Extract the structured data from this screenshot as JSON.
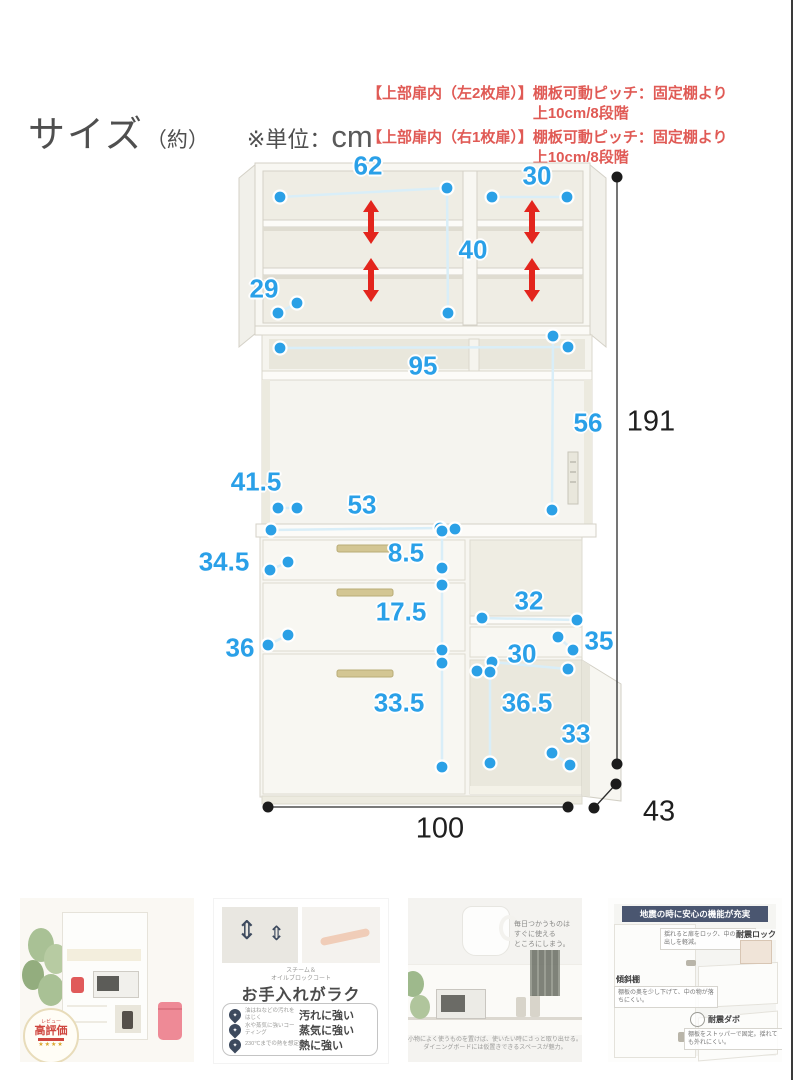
{
  "header": {
    "title_main": "サイズ",
    "title_paren": "（約）",
    "unit_prefix": "※単位：",
    "unit": "cm"
  },
  "notes": [
    {
      "bracket": "【上部扉内（左2枚扉）】",
      "text": "棚板可動ピッチ：固定棚より上10cm/8段階"
    },
    {
      "bracket": "【上部扉内（右1枚扉）】",
      "text": "棚板可動ピッチ：固定棚より上10cm/8段階"
    }
  ],
  "dims": {
    "w_top_left": "62",
    "w_top_right": "30",
    "h_top_inner": "40",
    "d_top": "29",
    "w_niche": "95",
    "h_niche": "56",
    "h_total": "191",
    "d_counter": "41.5",
    "w_counter_left": "53",
    "h_drawer1": "8.5",
    "d_drawer1": "34.5",
    "h_drawer2": "17.5",
    "d_drawer2": "36",
    "w_right_inner": "32",
    "h_right_drawer": "35",
    "w_right_lower": "30",
    "h_drawer3": "33.5",
    "h_right_lower": "36.5",
    "w_door": "33",
    "w_total": "100",
    "d_total": "43"
  },
  "colors": {
    "dim_blue": "#2AA0E8",
    "arrow_red": "#E3251D",
    "note_red": "#E05A55",
    "navy": "#4A5670",
    "black_dim": "#1F1F1F"
  },
  "thumbnails": {
    "thumb1": {
      "badge_top": "レビュー",
      "badge_main": "高評価",
      "badge_stars": "★★★★"
    },
    "thumb2": {
      "coat_line1": "スチーム＆",
      "coat_line2": "オイルブロックコート",
      "heading": "お手入れがラク",
      "rows": [
        {
          "icon": "stain-resistant-icon",
          "note": "油はねなどの汚れをはじく",
          "label": "汚れに強い"
        },
        {
          "icon": "steam-resistant-icon",
          "note": "水や蒸気に強いコーティング",
          "label": "蒸気に強い"
        },
        {
          "icon": "heat-resistant-icon",
          "note": "230℃までの熱を想定",
          "label": "熱に強い"
        }
      ]
    },
    "thumb3": {
      "note_line1": "毎日つかうものは",
      "note_line2": "すぐに使える",
      "note_line3": "ところにしまう。",
      "caption_line1": "小物によく使うものを置けば、使いたい時にさっと取り出せる。",
      "caption_line2": "ダイニングボードには仮置きできるスペースが魅力。"
    },
    "thumb4": {
      "header": "地震の時に安心の機能が充実",
      "label_lock": "耐震ロック",
      "tip_lock": "揺れると扉をロック、中の飛び出しを軽減。",
      "label_shelf": "傾斜棚",
      "tip_shelf": "棚板の奥を少し下げて、中の物が落ちにくい。",
      "label_dabo": "耐震ダボ",
      "tip_dabo": "棚板をストッパーで固定。揺れても外れにくい。"
    }
  }
}
